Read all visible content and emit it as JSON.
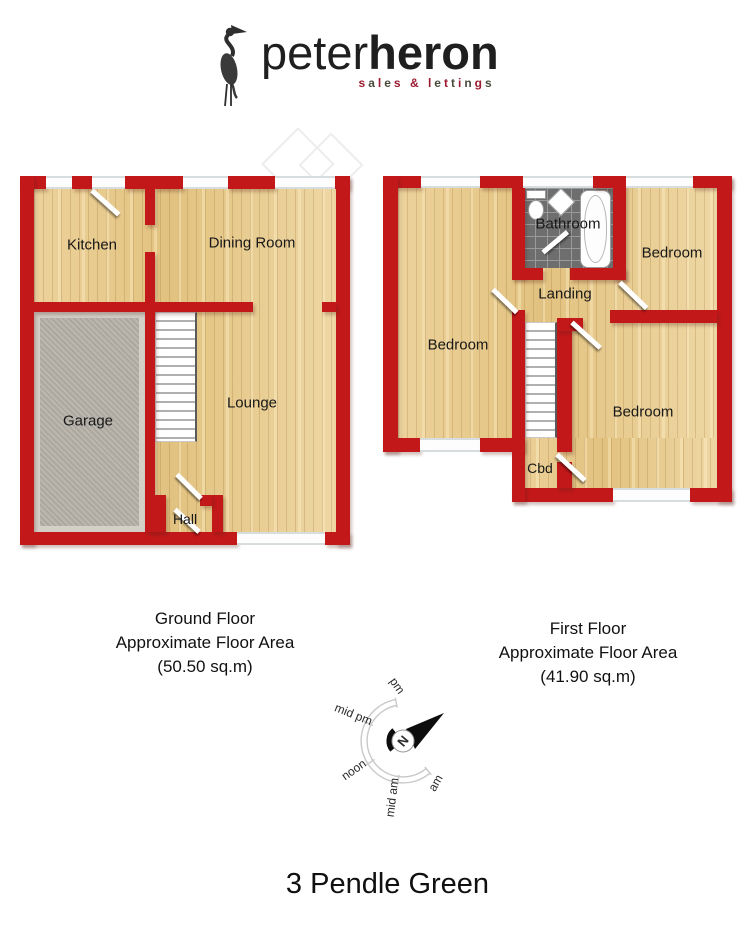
{
  "logo": {
    "brand_light": "peter",
    "brand_bold": "heron",
    "tagline": "sales & lettings"
  },
  "ground_floor": {
    "rooms": {
      "kitchen": "Kitchen",
      "dining": "Dining Room",
      "garage": "Garage",
      "lounge": "Lounge",
      "hall": "Hall"
    },
    "caption": {
      "line1": "Ground Floor",
      "line2": "Approximate Floor Area",
      "line3": "(50.50 sq.m)"
    }
  },
  "first_floor": {
    "rooms": {
      "bathroom": "Bathroom",
      "bedroom_front": "Bedroom",
      "bedroom_left": "Bedroom",
      "bedroom_back": "Bedroom",
      "landing": "Landing",
      "cbd": "Cbd"
    },
    "caption": {
      "line1": "First Floor",
      "line2": "Approximate Floor Area",
      "line3": "(41.90 sq.m)"
    }
  },
  "compass": {
    "north": "N",
    "labels": [
      "pm",
      "mid pm",
      "noon",
      "mid am",
      "am"
    ]
  },
  "title": "3 Pendle Green",
  "colors": {
    "wall_red": "#c2181a",
    "wood_floor": "#e8cc92",
    "tagline_red": "#9b1b30",
    "tagline_dark": "#4a4a3c"
  }
}
